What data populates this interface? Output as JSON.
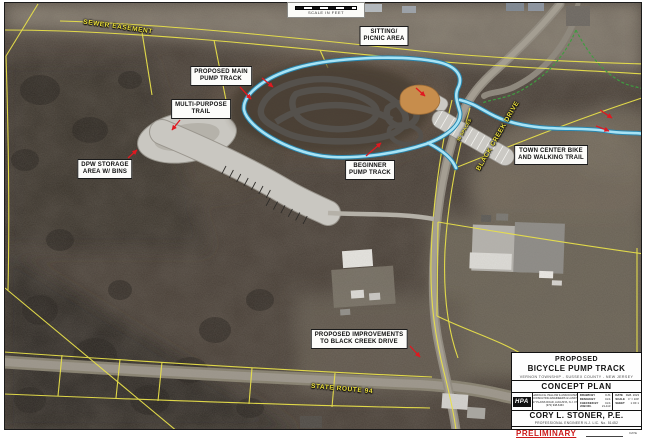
{
  "scale_bar": {
    "caption": "SCALE IN FEET"
  },
  "feature_labels": {
    "sitting_picnic": {
      "line1": "SITTING/",
      "line2": "PICNIC AREA"
    },
    "main_pump_track": {
      "line1": "PROPOSED MAIN",
      "line2": "PUMP TRACK"
    },
    "multi_purpose_trail": {
      "line1": "MULTI-PURPOSE",
      "line2": "TRAIL"
    },
    "dpw_storage": {
      "line1": "DPW STORAGE",
      "line2": "AREA W/ BINS"
    },
    "beginner_pump_track": {
      "line1": "BEGINNER",
      "line2": "PUMP TRACK"
    },
    "town_center_trail": {
      "line1": "TOWN CENTER BIKE",
      "line2": "AND WALKING TRAIL"
    },
    "black_creek_improvements": {
      "line1": "PROPOSED IMPROVEMENTS",
      "line2": "TO BLACK CREEK DRIVE"
    }
  },
  "road_labels": {
    "sewer_easement": "SEWER EASEMENT",
    "black_creek_drive": "BLACK CREEK DRIVE",
    "state_route_94": "STATE ROUTE 94",
    "parking_spaces": "30 SPACES"
  },
  "title_block": {
    "line1": "PROPOSED",
    "line2": "BICYCLE PUMP TRACK",
    "municipality": "VERNON TOWNSHIP - SUSSEX COUNTY - NEW JERSEY",
    "plan_type": "CONCEPT PLAN",
    "logo": "HPA",
    "firm_lines": [
      "HAROLD E. PELLOW & ASSOCIATES, INC.",
      "CONSULTING ENGINEERS & LAND SURVEYORS",
      "17 PLAINS ROAD, AUGUSTA, N.J. 07822",
      "(973) 948-6463"
    ],
    "fields_left": [
      {
        "label": "DRAWN BY",
        "value": "KJS"
      },
      {
        "label": "DESIGN BY",
        "value": "CLS"
      },
      {
        "label": "CHECKED BY",
        "value": "CLS"
      },
      {
        "label": "JOB NO.",
        "value": "21-113"
      }
    ],
    "fields_right": [
      {
        "label": "DATE",
        "value": "FEB. 2023"
      },
      {
        "label": "SCALE",
        "value": "1\" = 100'"
      },
      {
        "label": "SHEET",
        "value": "1 OF 1"
      }
    ],
    "engineer": "CORY L. STONER, P.E.",
    "license": "PROFESSIONAL ENGINEER N.J. LIC. No. 51452",
    "status": "PRELIMINARY",
    "date_label": "DATE"
  },
  "colors": {
    "parcel_line_yellow": "#e8e04a",
    "walking_trail_cyan": "#a8e3f5",
    "walking_trail_edge": "#2a86ad",
    "pump_track_gray": "#55514c",
    "dirt_jump_orange": "#c78d4c",
    "pointer_arrow_red": "#e01820",
    "preliminary_red": "#cc1a1a",
    "annotation_yellow": "#eee23e",
    "existing_trail_green": "#3f9c40"
  }
}
